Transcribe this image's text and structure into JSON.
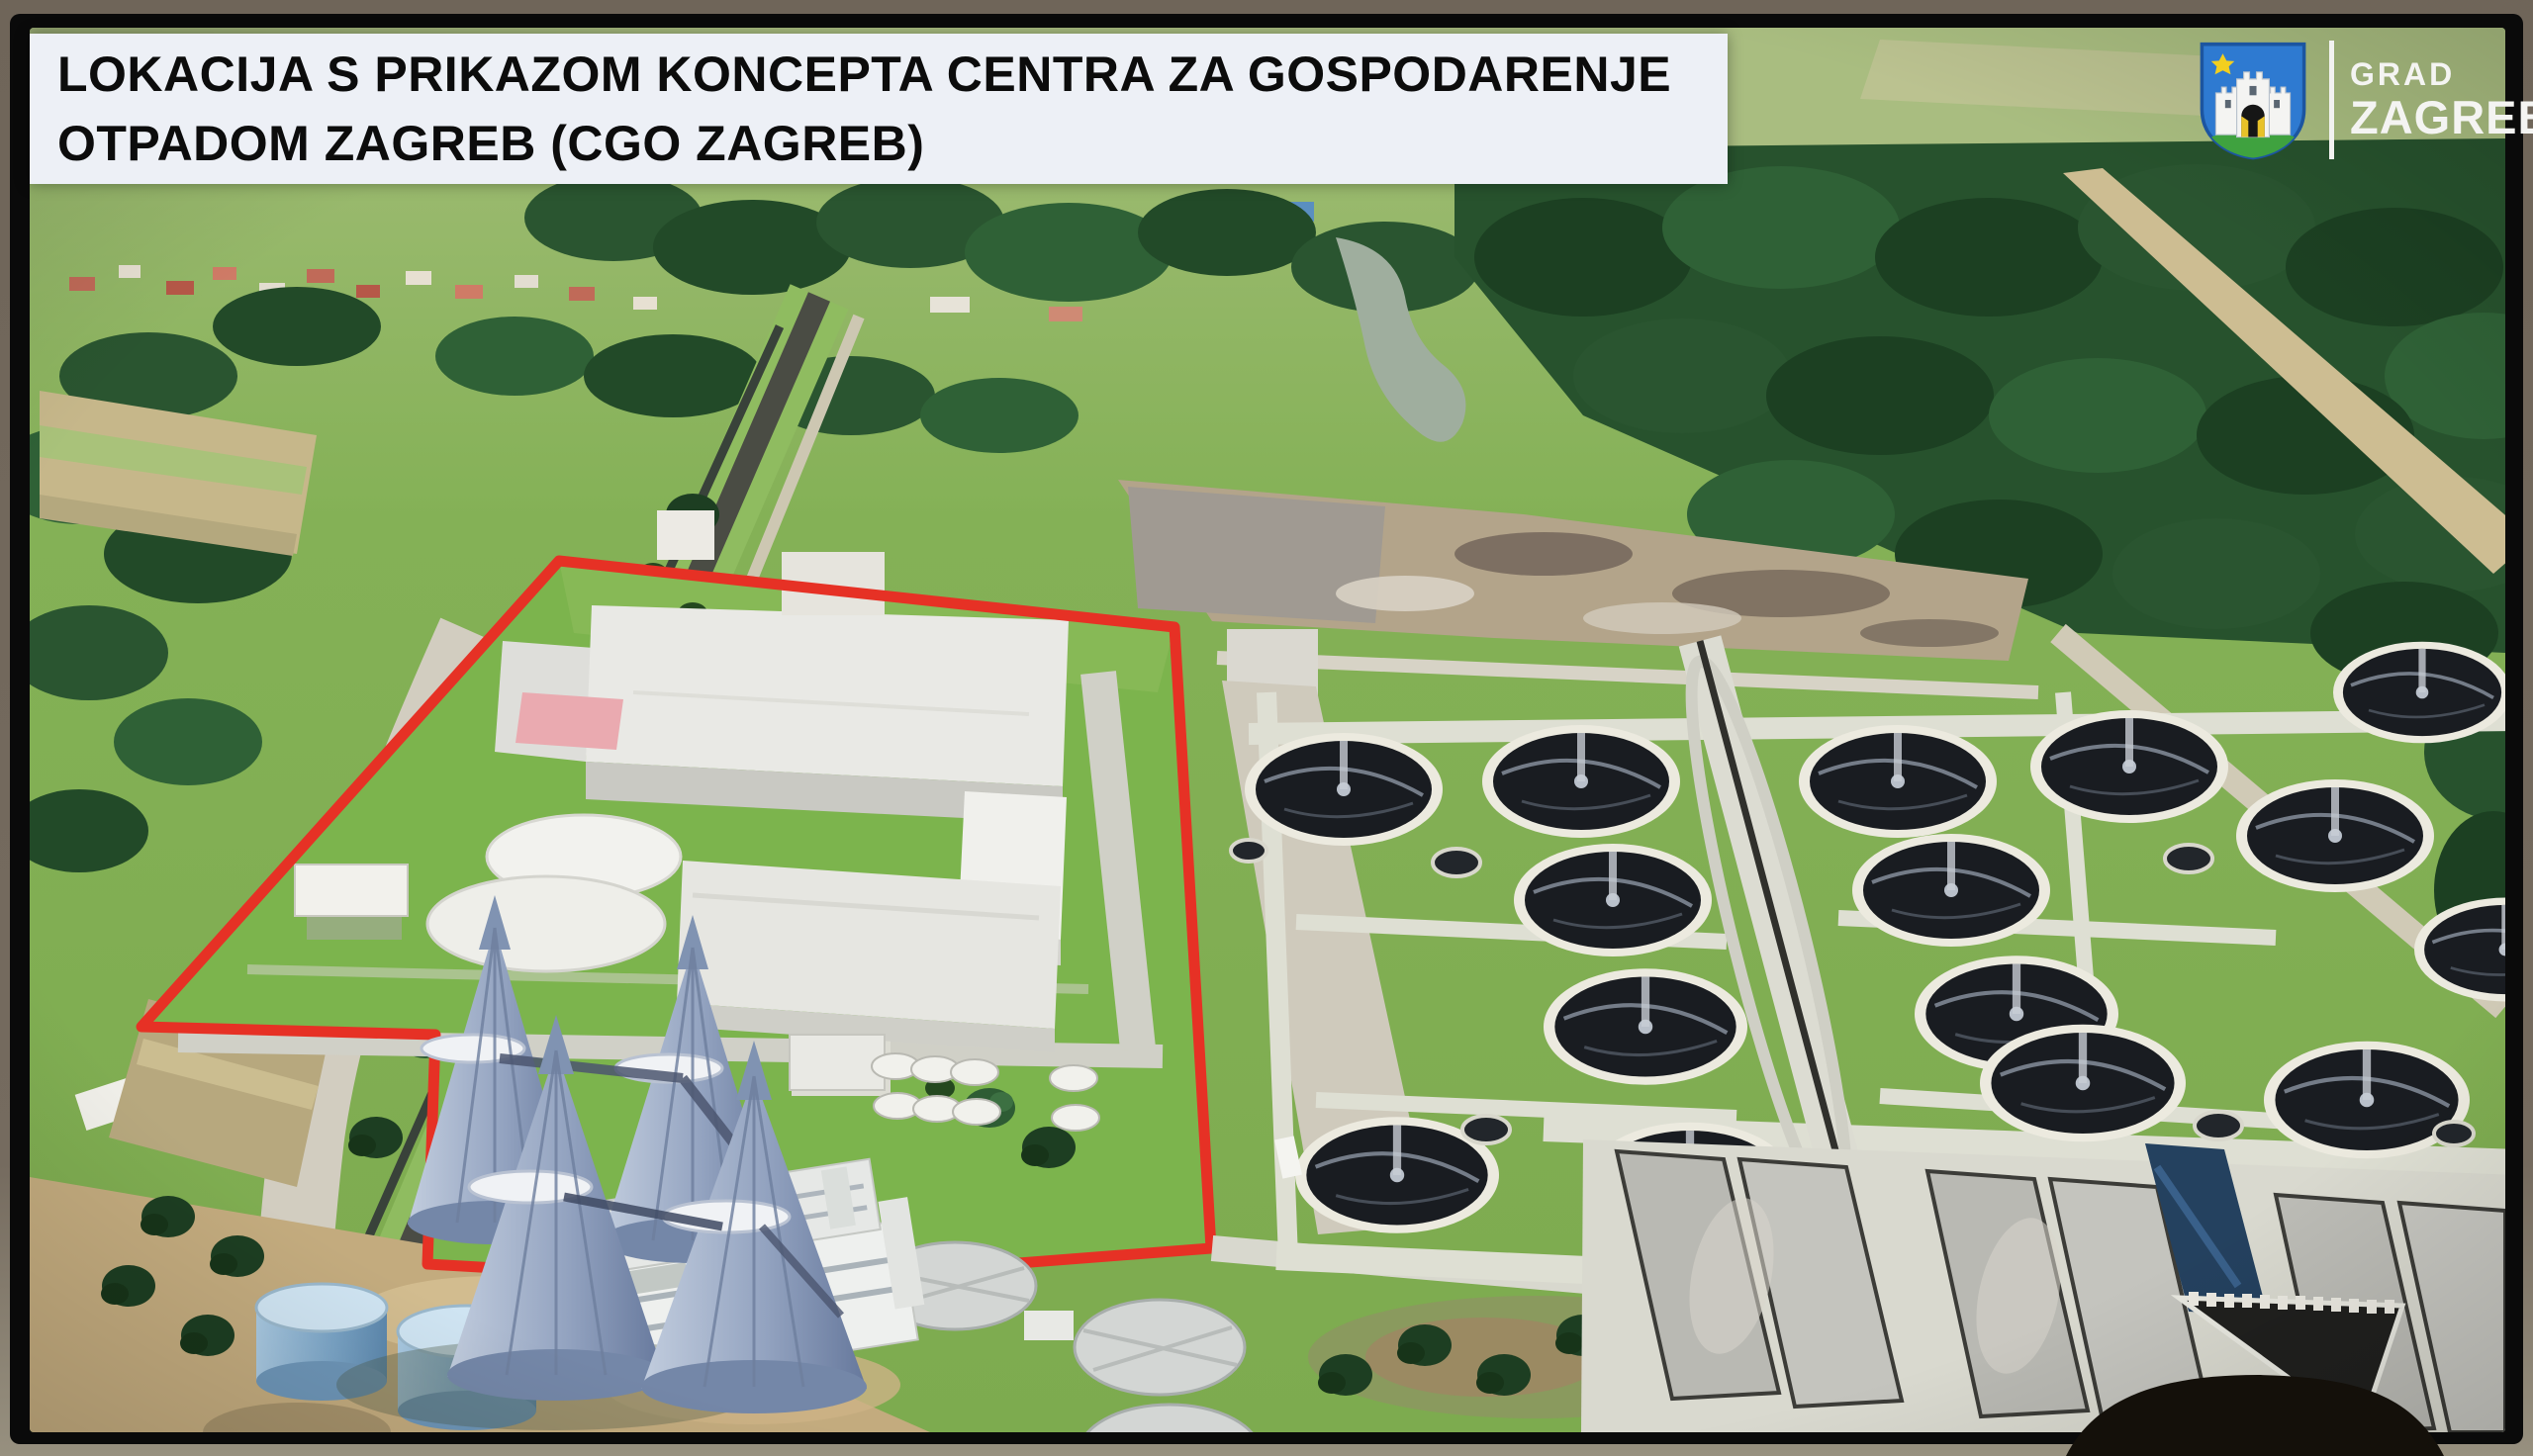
{
  "slide": {
    "title_line1": "LOKACIJA S PRIKAZOM KONCEPTA CENTRA ZA GOSPODARENJE",
    "title_line2": "OTPADOM ZAGREB (CGO ZAGREB)"
  },
  "logo": {
    "small_text": "GRAD",
    "large_text": "ZAGREB"
  },
  "icons": {
    "zagreb_coat_of_arms": "blue shield with white three-towered castle, yellow star, white crescent, green hill"
  },
  "colors": {
    "site_boundary_red": "#e63125",
    "banner_background": "#edf0f6",
    "title_text": "#0c0c0c",
    "logo_shield_blue": "#2e7ad1",
    "logo_text_white": "#f4f4f2",
    "grass_green": "#7cb44d",
    "clarifier_tank_dark": "#191c21",
    "concept_building_white": "#e9e9e5",
    "monitor_bezel_black": "#0a0a0a"
  }
}
